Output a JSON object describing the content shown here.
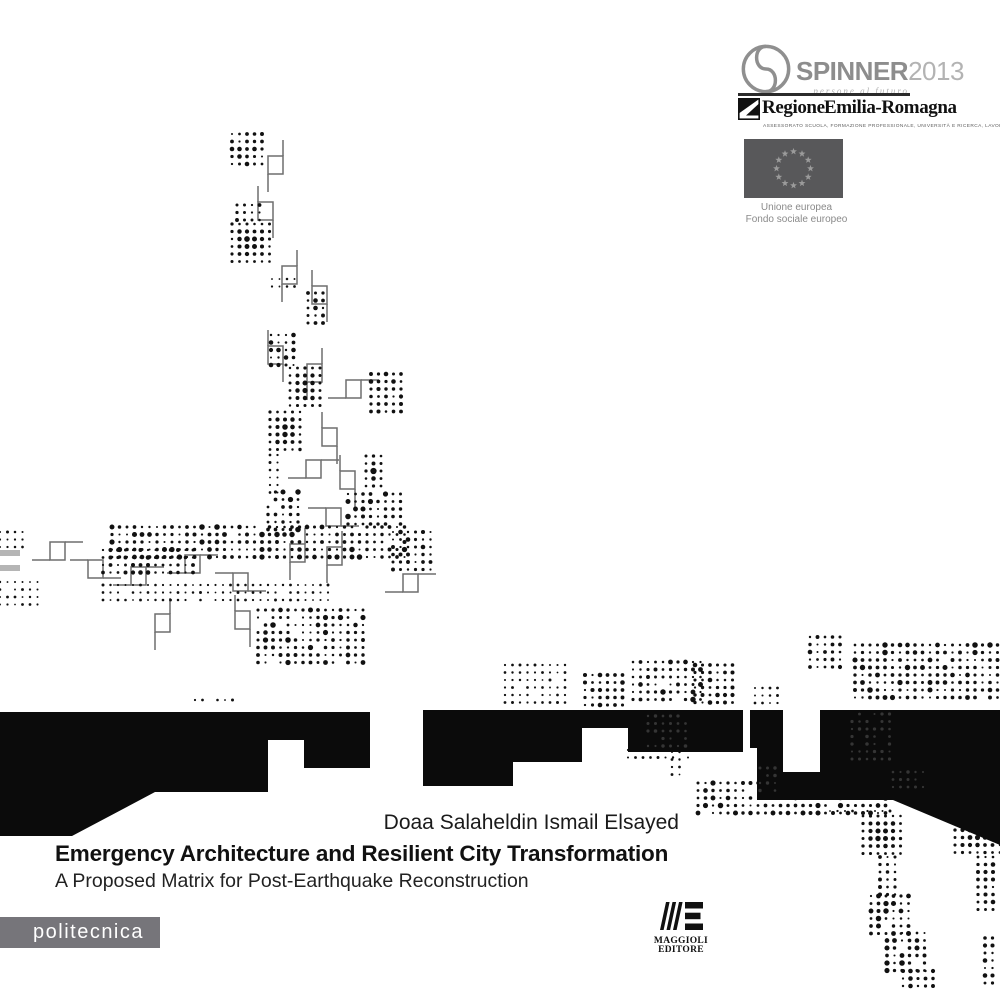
{
  "header": {
    "spinner": {
      "name": "SPINNER",
      "year": "2013",
      "tagline": "persone al futuro"
    },
    "regione": {
      "name": "Regione Emilia-Romagna",
      "subtitle": "Assessorato Scuola, Formazione Professionale, Università e Ricerca, Lavoro"
    },
    "eu": {
      "line1": "Unione europea",
      "line2": "Fondo sociale europeo"
    }
  },
  "titles": {
    "author": "Doaa Salaheldin Ismail Elsayed",
    "title": "Emergency Architecture and Resilient City Transformation",
    "subtitle": "A Proposed Matrix for Post-Earthquake Reconstruction"
  },
  "footer": {
    "series": "politecnica",
    "publisher": {
      "line1": "MAGGIOLI",
      "line2": "EDITORE"
    }
  },
  "colors": {
    "dot": "#111111",
    "glyph_stroke": "#6e6e6e",
    "black_shape": "#0b0b0b",
    "gray_dot": "#5a5a5a",
    "gray_rect": "#b5b5b5",
    "series_bar": "#76757a",
    "eu_flag_field": "#58585a",
    "eu_star": "#9b9b9b",
    "logo_gray": "#8d8d8d"
  },
  "artwork": {
    "dot_spacing": 7.5,
    "clusters": [
      [
        232,
        134,
        5,
        5,
        "m"
      ],
      [
        237,
        205,
        4,
        3,
        "m"
      ],
      [
        232,
        224,
        6,
        6,
        "d"
      ],
      [
        272,
        279,
        4,
        2,
        "s"
      ],
      [
        308,
        293,
        3,
        5,
        "m"
      ],
      [
        271,
        335,
        4,
        5,
        "m"
      ],
      [
        290,
        368,
        5,
        6,
        "d"
      ],
      [
        371,
        374,
        5,
        6,
        "m"
      ],
      [
        270,
        412,
        5,
        6,
        "d"
      ],
      [
        270,
        455,
        2,
        6,
        "s"
      ],
      [
        268,
        492,
        5,
        6,
        "x"
      ],
      [
        366,
        456,
        3,
        5,
        "d"
      ],
      [
        348,
        494,
        8,
        5,
        "x"
      ],
      [
        112,
        527,
        40,
        5,
        "x"
      ],
      [
        0,
        532,
        4,
        3,
        "s"
      ],
      [
        103,
        550,
        13,
        4,
        "m"
      ],
      [
        0,
        582,
        6,
        4,
        "s"
      ],
      [
        103,
        585,
        31,
        3,
        "s"
      ],
      [
        258,
        610,
        15,
        8,
        "x"
      ],
      [
        393,
        532,
        6,
        6,
        "m"
      ],
      [
        195,
        700,
        6,
        1,
        "s"
      ],
      [
        505,
        665,
        9,
        6,
        "s"
      ],
      [
        585,
        675,
        6,
        5,
        "m"
      ],
      [
        633,
        662,
        10,
        6,
        "x"
      ],
      [
        695,
        665,
        6,
        6,
        "m"
      ],
      [
        755,
        688,
        4,
        3,
        "s"
      ],
      [
        810,
        637,
        5,
        5,
        "m"
      ],
      [
        855,
        645,
        20,
        8,
        "x"
      ],
      [
        628,
        750,
        9,
        2,
        "s"
      ],
      [
        672,
        752,
        2,
        4,
        "s"
      ],
      [
        698,
        783,
        26,
        5,
        "x"
      ],
      [
        830,
        811,
        9,
        1,
        "s"
      ],
      [
        863,
        816,
        6,
        6,
        "d"
      ],
      [
        955,
        815,
        7,
        6,
        "d"
      ],
      [
        880,
        857,
        3,
        6,
        "m"
      ],
      [
        978,
        857,
        3,
        8,
        "m"
      ],
      [
        871,
        896,
        6,
        6,
        "x"
      ],
      [
        887,
        933,
        6,
        6,
        "x"
      ],
      [
        903,
        971,
        5,
        3,
        "m"
      ],
      [
        985,
        938,
        2,
        7,
        "m"
      ]
    ],
    "glyphs": [
      [
        "V",
        283,
        140,
        1
      ],
      [
        "V",
        258,
        186,
        -1
      ],
      [
        "V",
        297,
        250,
        1
      ],
      [
        "V",
        312,
        270,
        -1
      ],
      [
        "V",
        268,
        330,
        -1
      ],
      [
        "V",
        322,
        348,
        1
      ],
      [
        "H",
        328,
        398,
        1
      ],
      [
        "V",
        322,
        412,
        -1
      ],
      [
        "H",
        288,
        478,
        1
      ],
      [
        "V",
        340,
        455,
        -1
      ],
      [
        "H",
        308,
        508,
        -1
      ],
      [
        "V",
        305,
        528,
        1
      ],
      [
        "V",
        342,
        531,
        1
      ],
      [
        "H",
        32,
        560,
        1
      ],
      [
        "H",
        70,
        560,
        -1
      ],
      [
        "H",
        113,
        585,
        1
      ],
      [
        "H",
        167,
        573,
        1
      ],
      [
        "H",
        215,
        573,
        -1
      ],
      [
        "V",
        170,
        598,
        1
      ],
      [
        "V",
        235,
        595,
        -1
      ],
      [
        "H",
        385,
        592,
        1
      ]
    ],
    "black_shapes": [
      [
        [
          0,
          712
        ],
        [
          370,
          712
        ],
        [
          370,
          768
        ],
        [
          304,
          768
        ],
        [
          304,
          740
        ],
        [
          268,
          740
        ],
        [
          268,
          792
        ],
        [
          155,
          792
        ],
        [
          72,
          836
        ],
        [
          0,
          836
        ]
      ],
      [
        [
          423,
          710
        ],
        [
          743,
          710
        ],
        [
          743,
          752
        ],
        [
          628,
          752
        ],
        [
          628,
          728
        ],
        [
          582,
          728
        ],
        [
          582,
          762
        ],
        [
          513,
          762
        ],
        [
          513,
          786
        ],
        [
          423,
          786
        ]
      ],
      [
        [
          750,
          710
        ],
        [
          783,
          710
        ],
        [
          783,
          748
        ],
        [
          750,
          748
        ]
      ],
      [
        [
          820,
          710
        ],
        [
          1000,
          710
        ],
        [
          1000,
          845
        ],
        [
          893,
          800
        ],
        [
          757,
          800
        ],
        [
          757,
          748
        ],
        [
          783,
          748
        ],
        [
          783,
          772
        ],
        [
          820,
          772
        ]
      ]
    ],
    "gray_dot_clusters": [
      [
        852,
        714,
        6,
        7
      ],
      [
        648,
        716,
        6,
        5
      ],
      [
        893,
        772,
        5,
        3
      ],
      [
        760,
        768,
        3,
        4
      ]
    ],
    "gray_rects": [
      [
        0,
        550,
        20,
        6
      ],
      [
        0,
        565,
        20,
        6
      ]
    ]
  }
}
